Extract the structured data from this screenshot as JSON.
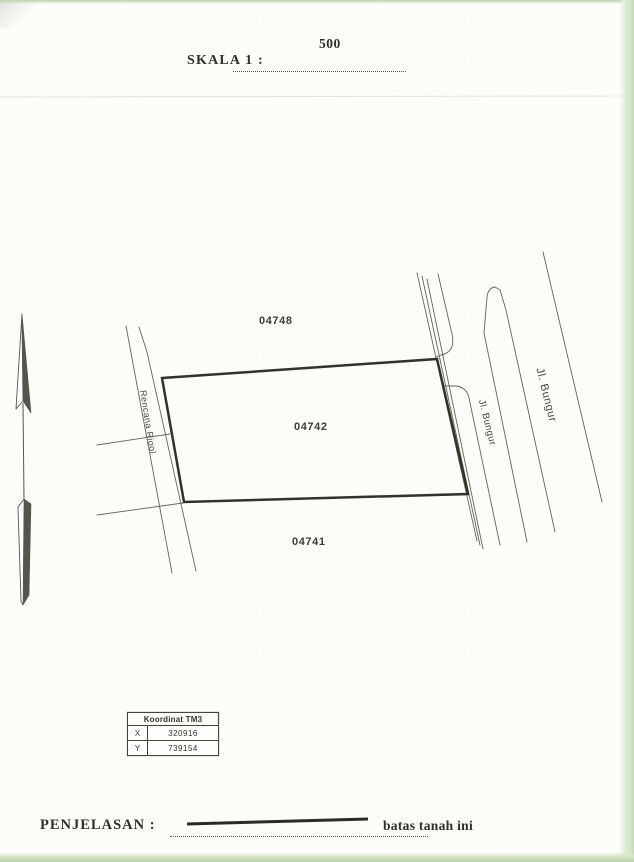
{
  "document": {
    "scale_label": "SKALA 1 :",
    "scale_value": "500",
    "penjelasan_label": "PENJELASAN :",
    "legend_caption": "batas tanah ini"
  },
  "map": {
    "parcels": [
      {
        "id": "04748"
      },
      {
        "id": "04742"
      },
      {
        "id": "04741"
      }
    ],
    "labels": {
      "canal": "Rencana Riool",
      "street_inner": "Jl. Bungur",
      "street_outer": "Jl. Bungur"
    }
  },
  "coordinate_table": {
    "title": "Koordinat TM3",
    "rows": [
      {
        "label": "X",
        "value": "320916"
      },
      {
        "label": "Y",
        "value": "739154"
      }
    ]
  },
  "colors": {
    "ink": "#2f2f2a",
    "boundary_line": "#32322c",
    "map_line": "#5a5a52",
    "paper": "#fcfcf9",
    "scan_edge_green": "#c6dcba"
  }
}
